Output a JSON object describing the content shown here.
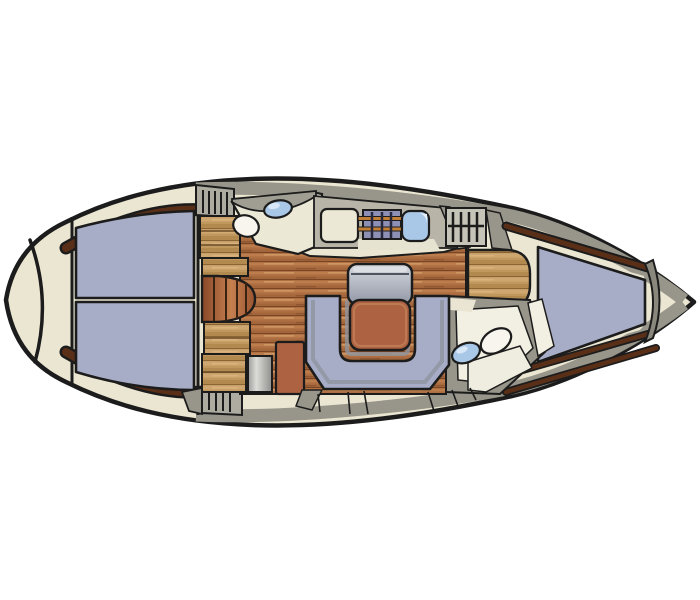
{
  "diagram": {
    "kind": "sailboat-interior-floor-plan",
    "orientation": "bow-left-stern-right",
    "rooms": [
      "bow-anchor-locker",
      "forward-cabin",
      "forward-head",
      "saloon",
      "galley",
      "companionway",
      "nav-station",
      "aft-head",
      "aft-cabin"
    ]
  },
  "colors": {
    "hull": "#ebe6d2",
    "outline": "#1c1c1c",
    "deck_gray": "#98968a",
    "wall_gray": "#a09e92",
    "cushion_blue": "#a7adc6",
    "trim_brown": "#5a2f18",
    "floor_wood": "#ad6f42",
    "cabinet_wood": "#c0985e",
    "furniture_brown": "#ad6342",
    "sink_blue": "#a9c7e6",
    "stove_purple": "#8e8fb4",
    "stove_rail_orange": "#c27f35",
    "toilet_white": "#f7f5ee",
    "room_floor": "#ece8d6",
    "steps_bg": "#c6c4b8",
    "metal_gray": "#bdbdb9",
    "stern_band": "#8a887c"
  }
}
